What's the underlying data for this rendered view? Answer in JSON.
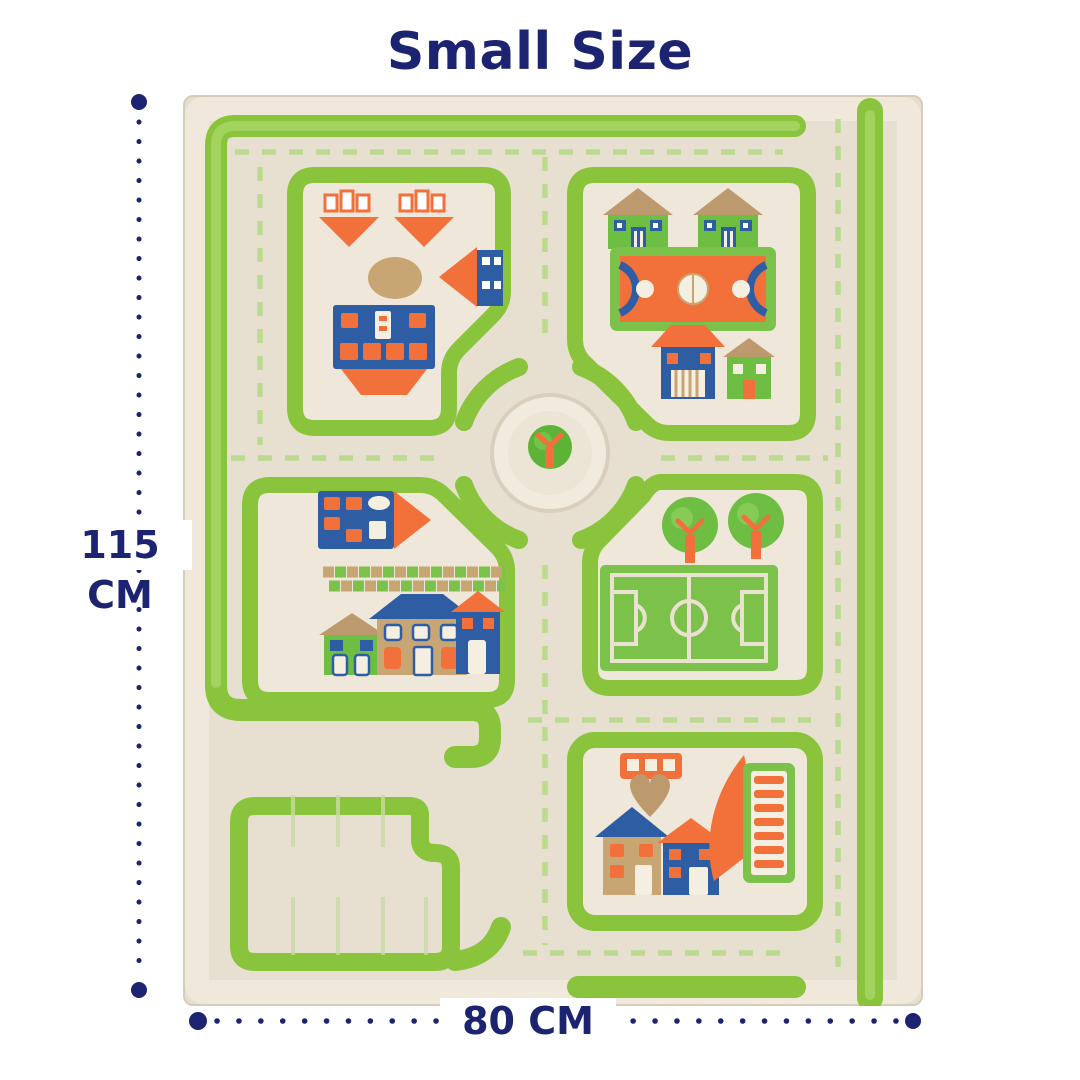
{
  "title": "Small Size",
  "dimensions": {
    "height_label": "115 CM",
    "width_label": "80 CM"
  },
  "colors": {
    "navy": "#1c2471",
    "grass_green": "#8ac43c",
    "grass_green_light": "#a7d767",
    "road_dash_green": "#b9d98c",
    "rug_cream": "#e7dfd0",
    "block_cream": "#efe8da",
    "orange": "#f2703a",
    "house_blue": "#2e5da4",
    "house_green": "#6fbe44",
    "roof_tan": "#bd9a6d"
  },
  "rug": {
    "description": "Overhead view of a cream and green 3D children's traffic play rug with looping roads, house blocks, basketball court, soccer field, tree roundabout and a parking lot"
  }
}
